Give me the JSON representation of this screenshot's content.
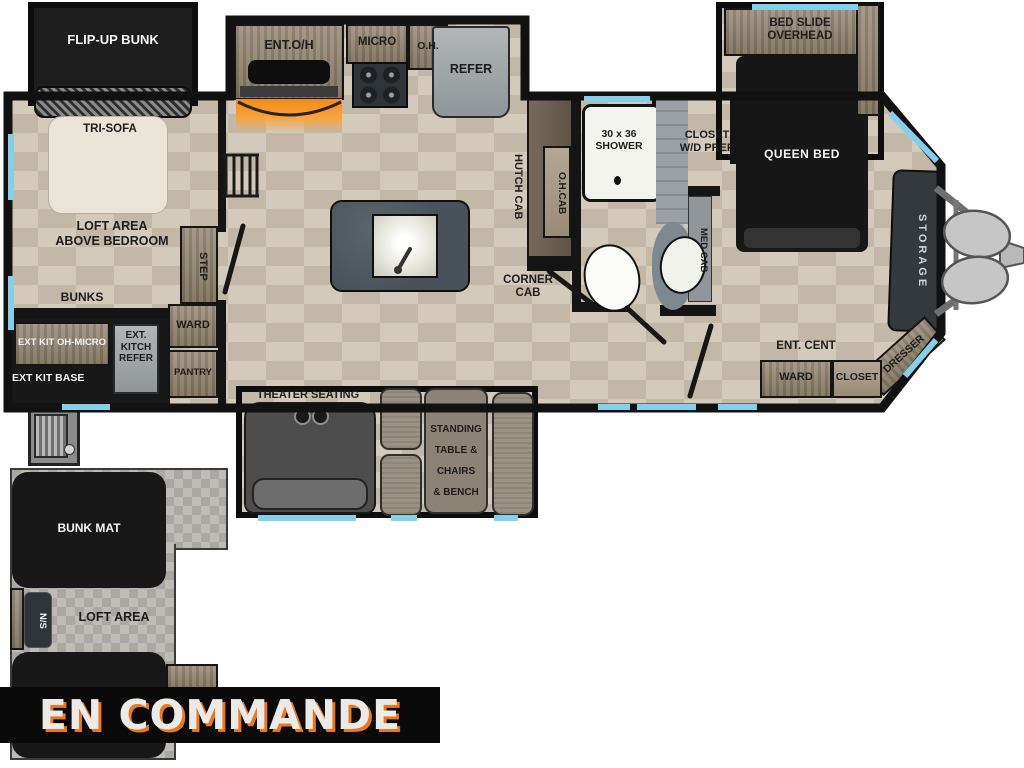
{
  "banner": {
    "label": "EN COMMANDE"
  },
  "colors": {
    "accent_orange": "#e87722",
    "window_blue": "#86cfe8",
    "wall_black": "#141414",
    "floor_tan": "#cdc3b4",
    "slide_black": "#1b1b1b"
  },
  "plan": {
    "left_wing": {
      "flip_up_bunk": "FLIP-UP BUNK",
      "tri_sofa": "TRI-SOFA",
      "loft_above": [
        "LOFT AREA",
        "ABOVE BEDROOM"
      ],
      "bunks": "BUNKS",
      "step": "STEP",
      "ward": "WARD",
      "pantry": "PANTRY",
      "ext_kit_oh_micro": "EXT KIT OH-MICRO",
      "ext_kitch_refer": [
        "EXT.",
        "KITCH",
        "REFER"
      ],
      "ext_kit_base": "EXT KIT BASE"
    },
    "kitchen": {
      "ent_oh": "ENT.O/H",
      "micro": "MICRO",
      "oh": "O.H.",
      "refer": "REFER",
      "hutch_cab": "HUTCH CAB",
      "oh_cab": "O.H.CAB",
      "corner_cab": [
        "CORNER",
        "CAB"
      ]
    },
    "bath": {
      "shower": [
        "30 x 36",
        "SHOWER"
      ],
      "closet_wd": [
        "CLOSET",
        "W/D PREP"
      ],
      "med_cab": "MED CAB"
    },
    "bedroom": {
      "bed_slide": [
        "BED SLIDE",
        "OVERHEAD"
      ],
      "queen_bed": "QUEEN BED",
      "storage": "STORAGE",
      "dresser": "DRESSER",
      "ent_cent": "ENT. CENT",
      "ward": "WARD",
      "closet": "CLOSET"
    },
    "living": {
      "theater": "THEATER SEATING",
      "free_standing": [
        "FREE",
        "STANDING",
        "TABLE &",
        "CHAIRS",
        "& BENCH"
      ]
    },
    "loft": {
      "bunk_mat": "BUNK MAT",
      "ns": "N/S",
      "loft_area": "LOFT AREA"
    }
  }
}
